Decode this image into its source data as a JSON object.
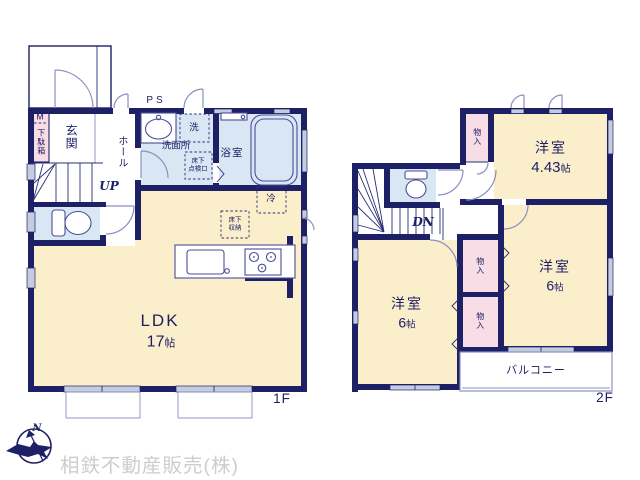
{
  "plan": {
    "floor1": {
      "floor_label": "1F",
      "labels": {
        "meter": "M",
        "shoe_cabinet": "下駄箱",
        "entrance": "玄関",
        "hall": "ホール",
        "stairs_up": "UP",
        "pipe_space": "PS",
        "washroom": "洗面所",
        "washer": "洗",
        "bathroom": "浴室",
        "underfloor_hatch_1": "床下",
        "underfloor_hatch_2": "点検口",
        "refrigerator": "冷",
        "underfloor_storage_1": "床下",
        "underfloor_storage_2": "収納",
        "ldk_name": "LDK",
        "ldk_size_value": "17",
        "ldk_size_unit": "帖"
      }
    },
    "floor2": {
      "floor_label": "2F",
      "labels": {
        "stairs_down": "DN",
        "closet_a": "物入",
        "closet_b": "物入",
        "closet_c": "物入",
        "bedroom1_name": "洋室",
        "bedroom1_size_value": "4.43",
        "bedroom1_size_unit": "帖",
        "bedroom2_name": "洋室",
        "bedroom2_size_value": "6",
        "bedroom2_size_unit": "帖",
        "bedroom3_name": "洋室",
        "bedroom3_size_value": "6",
        "bedroom3_size_unit": "帖",
        "balcony": "バルコニー"
      }
    },
    "footer": {
      "compass_north": "N",
      "company": "相鉄不動産販売(株)"
    }
  },
  "colors": {
    "wall": "#1e2066",
    "room_cream": "#fbeecb",
    "room_wet_blue": "#d9e6f4",
    "closet_pink": "#f8dce6",
    "window_gray": "#c6cce0",
    "logo_gray": "#cdcdcd"
  }
}
